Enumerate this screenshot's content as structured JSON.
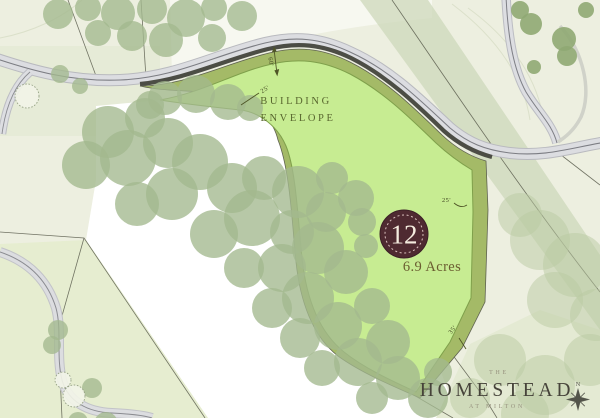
{
  "map": {
    "lot": {
      "number": "12",
      "area": "6.9 Acres"
    },
    "envelope_label": {
      "line1": "BUILDING",
      "line2": "ENVELOPE"
    },
    "dimensions": {
      "road_frontage": "60'",
      "building_line": "25'",
      "side": "25'",
      "rear": "35'"
    },
    "compass": {
      "north": "N"
    }
  },
  "branding": {
    "prefix": "THE",
    "name": "HOMESTEAD",
    "suffix": "AT MILTON"
  },
  "colors": {
    "background": "#edefe0",
    "lot_fill": "#a4ba67",
    "envelope_fill": "#c7ec92",
    "road_fill": "#dcdde1",
    "road_casing": "#b9babf",
    "frontage_band": "#4c4d45",
    "tree_sage": "#a3b88e",
    "tree_pale": "#b9c9a2",
    "badge_fill": "#4f2a31",
    "badge_text": "#f5ecdf",
    "area_text": "#6b5e31",
    "envelope_text": "#58662e",
    "logo_text": "#46433a",
    "logo_sub_text": "#95907d"
  }
}
